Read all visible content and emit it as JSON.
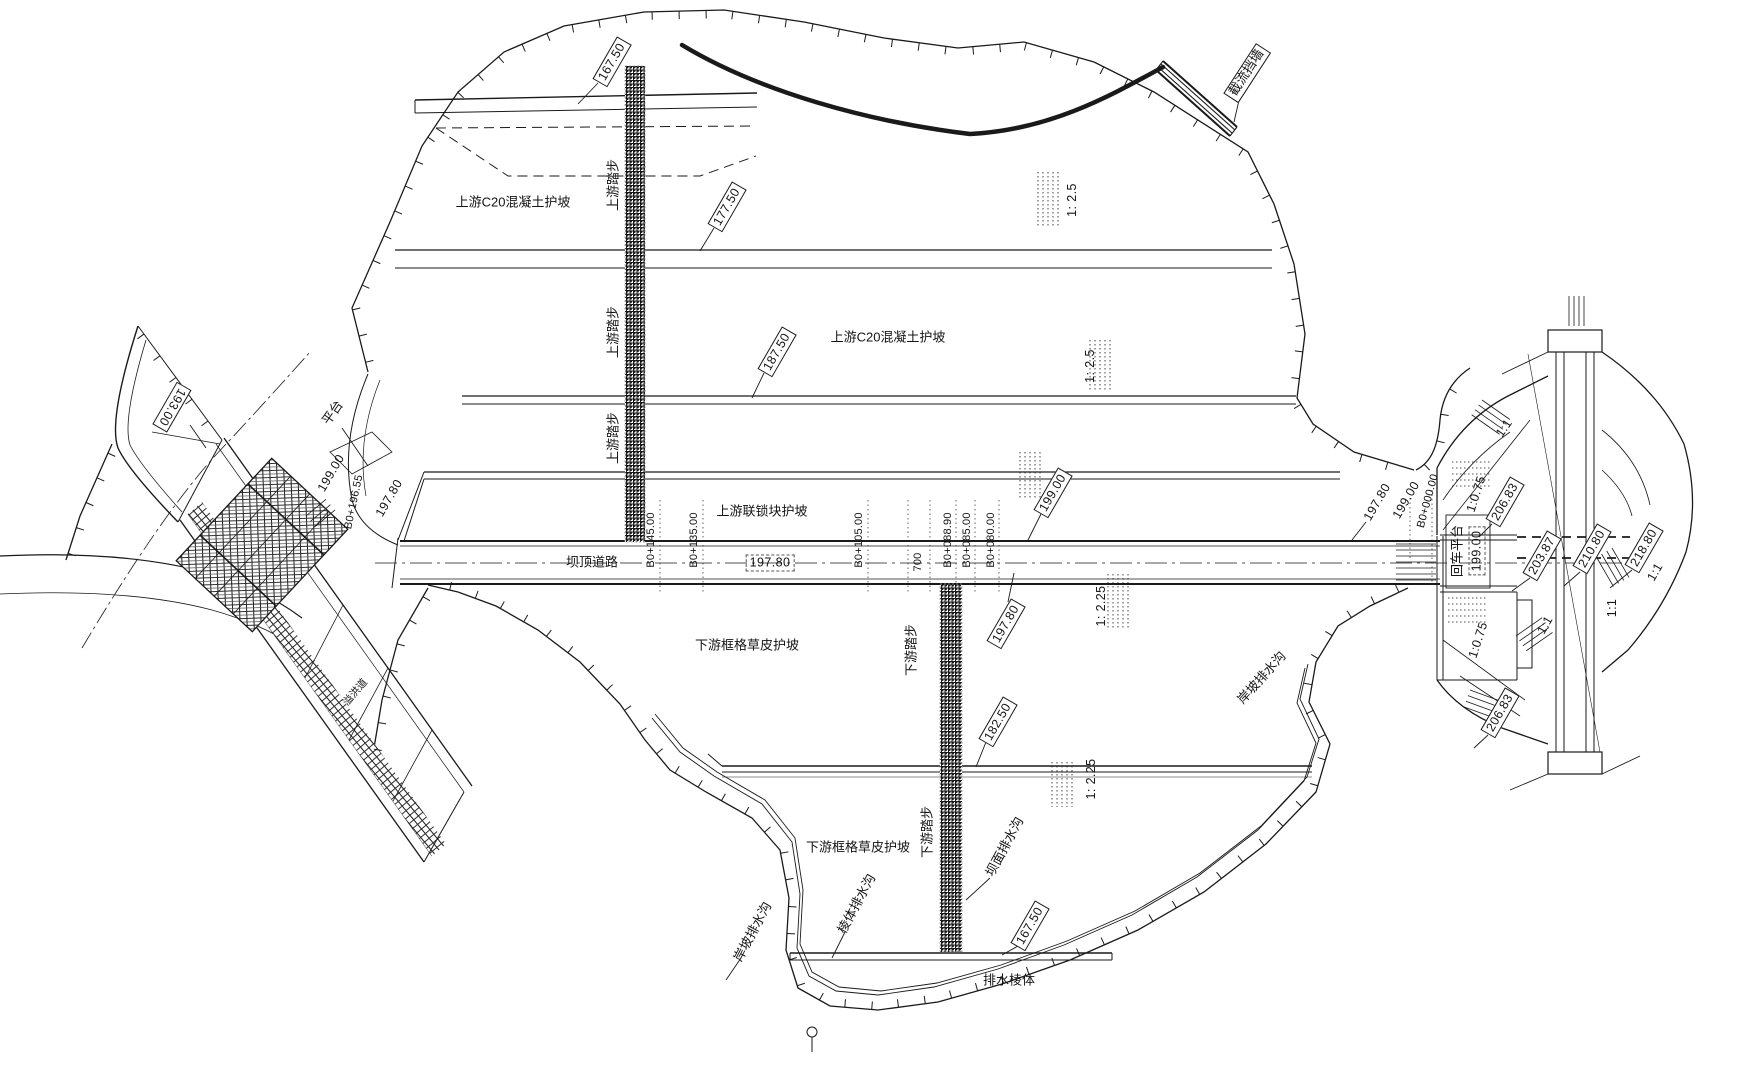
{
  "upstream": {
    "concrete_slope_label": "上游C20混凝土护坡",
    "interlock_slope_label": "上游联锁块护坡",
    "steps_label": "上游踏步",
    "elev_167_50": "167.50",
    "elev_177_50": "177.50",
    "elev_187_50": "187.50",
    "elev_199_00": "199.00",
    "slope_1_2_5": "1: 2.5",
    "closure_wall_label": "截流挡墙"
  },
  "crest": {
    "road_label": "坝顶道路",
    "road_elev": "197.80",
    "sta_b0_145": "B0+145.00",
    "sta_b0_135": "B0+135.00",
    "sta_b0_105": "B0+105.00",
    "dim_700": "700",
    "sta_b0_088_90": "B0+088.90",
    "sta_b0_085": "B0+085.00",
    "sta_b0_080": "B0+080.00"
  },
  "downstream": {
    "grid_grass_slope_label": "下游框格草皮护坡",
    "steps_label": "下游踏步",
    "elev_197_80": "197.80",
    "elev_182_50": "182.50",
    "elev_167_50": "167.50",
    "slope_1_2_25": "1: 2.25",
    "dam_face_drain_label": "坝面排水沟",
    "prism_drain_label": "棱体排水沟",
    "bank_drain_label": "岸坡排水沟",
    "drain_prism_label": "排水棱体"
  },
  "left_structure": {
    "elev_193_00": "193.00",
    "platform_label": "平台",
    "elev_199_00": "199.00",
    "sta_b0_196_55": "B0+196.55",
    "elev_197_80": "197.80",
    "spillway_label": "溢洪道"
  },
  "right_structure": {
    "elev_197_80": "197.80",
    "elev_199_00": "199.00",
    "sta_b0_000": "B0+000.00",
    "slope_1_0_75": "1:0.75",
    "elev_206_83": "206.83",
    "slope_1_1": "1:1",
    "turnaround_label": "回车平台",
    "turnaround_elev": "199.00",
    "elev_203_87": "203.87",
    "elev_210_80": "210.80",
    "elev_218_80": "218.80",
    "bank_drain_label": "岸坡排水沟"
  }
}
